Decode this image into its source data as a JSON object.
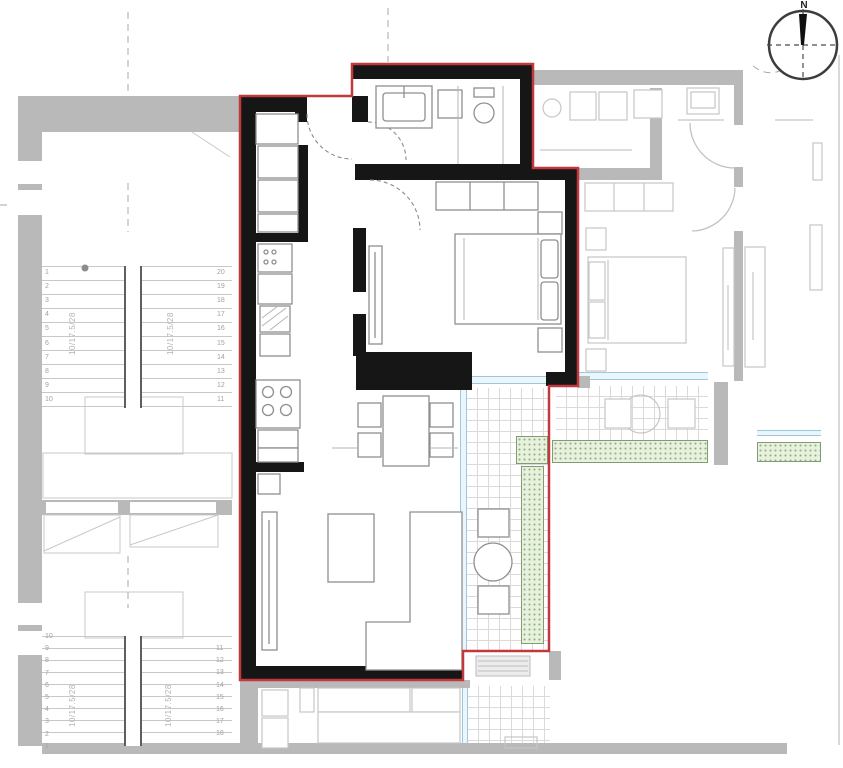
{
  "plan": {
    "compass": {
      "label": "N"
    },
    "stairs": {
      "upper": {
        "spec": "10/17.5/28",
        "left_numbers": [
          "1",
          "2",
          "3",
          "4",
          "5",
          "6",
          "7",
          "8",
          "9",
          "10"
        ],
        "right_numbers": [
          "20",
          "19",
          "18",
          "17",
          "16",
          "15",
          "14",
          "13",
          "12",
          "11"
        ]
      },
      "lower": {
        "spec": "10/17.5/28",
        "left_numbers": [
          "10",
          "9",
          "8",
          "7",
          "6",
          "5",
          "4",
          "3",
          "2",
          "1"
        ],
        "right_numbers": [
          "11",
          "12",
          "13",
          "14",
          "15",
          "16",
          "17",
          "18"
        ]
      }
    },
    "colors": {
      "unit_outline": "#c2393c",
      "unit_wall": "#161616",
      "neighbor_wall": "#b9b9b9",
      "glazing": "#9cc8da",
      "planter_fill": "#e7f1de",
      "planter_dot": "#8fae7d",
      "tile_line": "#dadada",
      "stair_line": "#c8c8c8"
    }
  }
}
